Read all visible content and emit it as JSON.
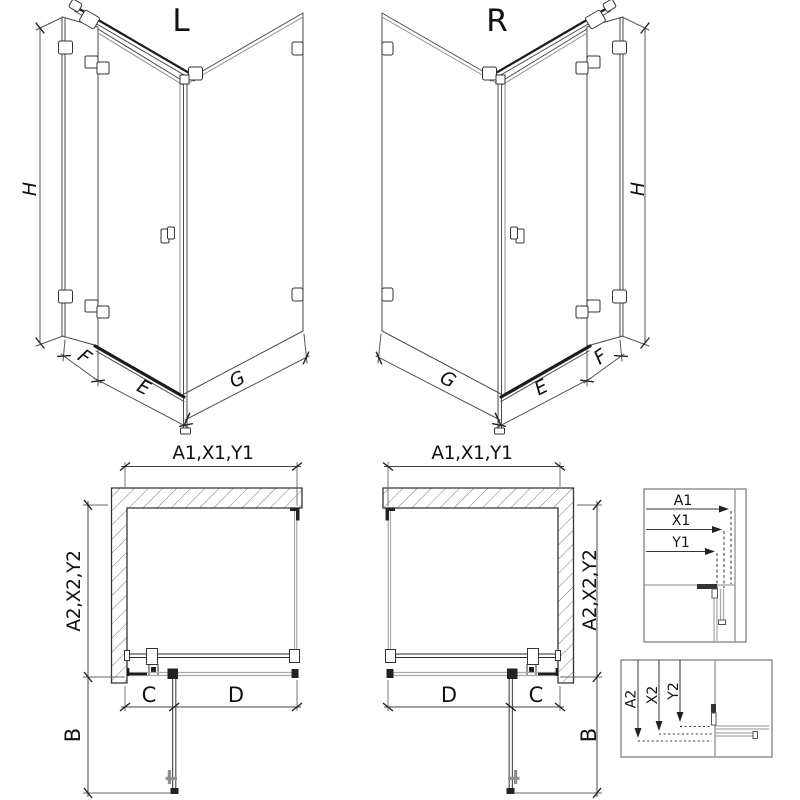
{
  "views": {
    "l3d": {
      "name": "L",
      "h": "H",
      "f": "F",
      "e": "E",
      "g": "G"
    },
    "r3d": {
      "name": "R",
      "h": "H",
      "f": "F",
      "e": "E",
      "g": "G"
    },
    "lplan": {
      "top": "A1,X1,Y1",
      "side": "A2,X2,Y2",
      "c": "C",
      "d": "D",
      "b": "B"
    },
    "rplan": {
      "top": "A1,X1,Y1",
      "side": "A2,X2,Y2",
      "c": "C",
      "d": "D",
      "b": "B"
    }
  },
  "details": {
    "top": {
      "a1": "A1",
      "x1": "X1",
      "y1": "Y1"
    },
    "bottom": {
      "a2": "A2",
      "x2": "X2",
      "y2": "Y2"
    }
  },
  "colors": {
    "line": "#2b2b2b",
    "glass": "#a8a8a8",
    "hatch": "#777777",
    "dim": "#444444",
    "box_border": "#8a8a8a",
    "text": "#111111",
    "background": "#ffffff"
  }
}
